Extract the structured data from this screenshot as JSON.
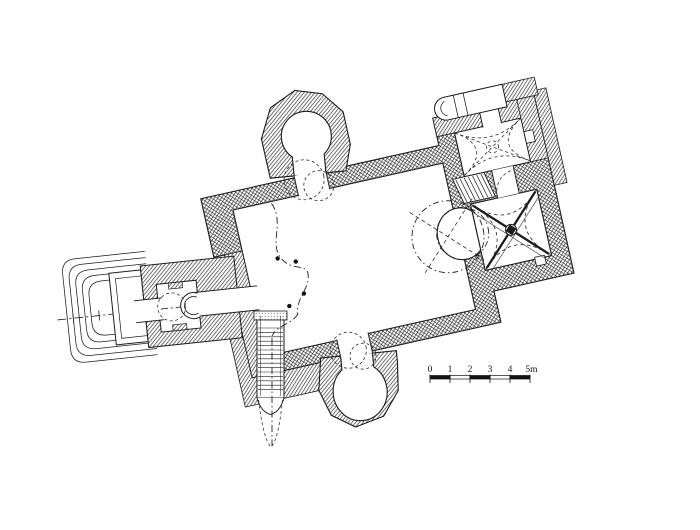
{
  "drawing": {
    "kind": "architectural floor plan (church, measured survey drawing)",
    "ink": "#1c1c1c",
    "background": "#ffffff"
  },
  "scale_bar": {
    "labels": [
      "0",
      "1",
      "2",
      "3",
      "4",
      "5m"
    ],
    "segment_meters": 1,
    "total_meters": 5
  }
}
